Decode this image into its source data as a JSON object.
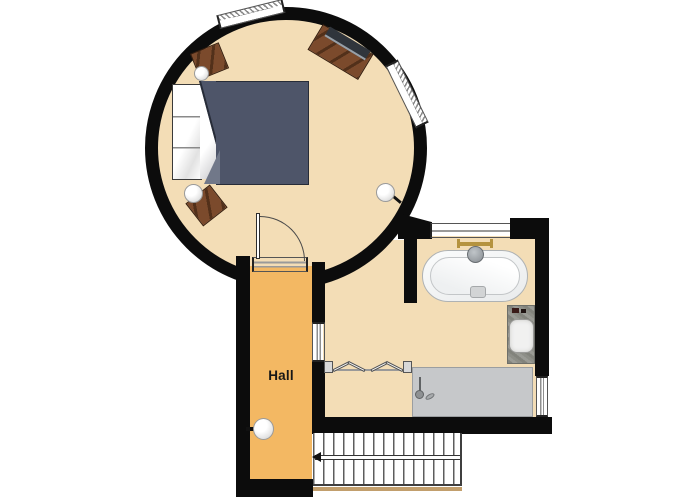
{
  "plan": {
    "rooms": {
      "hall": {
        "label": "Hall"
      }
    }
  },
  "colors": {
    "wall": "#0c0c0c",
    "floor": "#f3ddb6",
    "hall-floor": "#f3b863",
    "duvet": "#4e5569",
    "duvet-dark": "#272c38",
    "duvet-fold": "#717889",
    "wood": "#7b4a2c",
    "wood-dark": "#52301a",
    "shower": "#c6c8ca",
    "granite": "#8f9089",
    "stair-trim": "#c29f6d",
    "brass": "#b5933f"
  }
}
